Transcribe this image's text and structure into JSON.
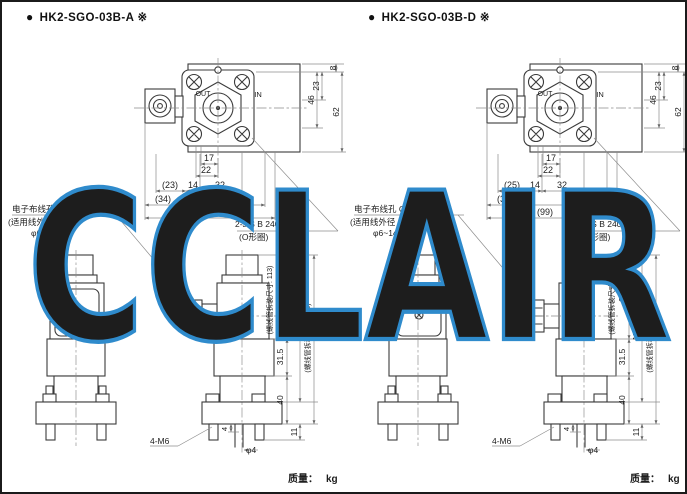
{
  "watermark": {
    "text": "CCLAIR",
    "color": "#2f8bcc"
  },
  "models": [
    {
      "bullet": "●",
      "title": "HK2-SGO-03B-A ※",
      "top": {
        "out": "OUT",
        "in": "IN",
        "d8": "8",
        "d23": "23",
        "d46": "46",
        "d62": "62",
        "d17": "17",
        "d22": "22",
        "r1a": "(23)",
        "r1b": "14",
        "r1c": "32",
        "r2a": "(34)",
        "r2b": "63",
        "r3": "(97)"
      },
      "notes": {
        "oring1": "2-JIS B 2401-1AP9",
        "oring2": "(O形圈)",
        "wiring1": "电子布线孔 G1/2",
        "wiring2": "(适用线外径",
        "wiring3": "φ6~14)"
      },
      "side": {
        "sol_inner": "(螺线管拆装尺寸: 113)",
        "h1": "66.5",
        "htot": "138",
        "h2": "31.5",
        "sol_outer": "(螺线管拆装尺寸: 185)",
        "h3": "40",
        "h4": "11",
        "p4": "4",
        "bolts": "4-M6",
        "drain": "φ4"
      },
      "mass_label": "质量：",
      "mass_unit": "kg"
    },
    {
      "bullet": "●",
      "title": "HK2-SGO-03B-D ※",
      "top": {
        "out": "OUT",
        "in": "IN",
        "d8": "8",
        "d23": "23",
        "d46": "46",
        "d62": "62",
        "d17": "17",
        "d22": "22",
        "r1a": "(25)",
        "r1b": "14",
        "r1c": "32",
        "r2a": "(36)",
        "r2b": "63",
        "r3": "(99)"
      },
      "notes": {
        "oring1": "2-JIS B 2401-1AP9",
        "oring2": "(O形圈)",
        "wiring1": "电子布线孔 G1/2",
        "wiring2": "(适用线外径",
        "wiring3": "φ6~14)"
      },
      "side": {
        "sol_inner": "(螺线管拆装尺寸: 140)",
        "h1": "80",
        "htot": "151.5",
        "h2": "31.5",
        "sol_outer": "(螺线管拆装尺寸: 212)",
        "h3": "40",
        "h4": "11",
        "p4": "4",
        "bolts": "4-M6",
        "drain": "φ4"
      },
      "mass_label": "质量：",
      "mass_unit": "kg"
    }
  ]
}
